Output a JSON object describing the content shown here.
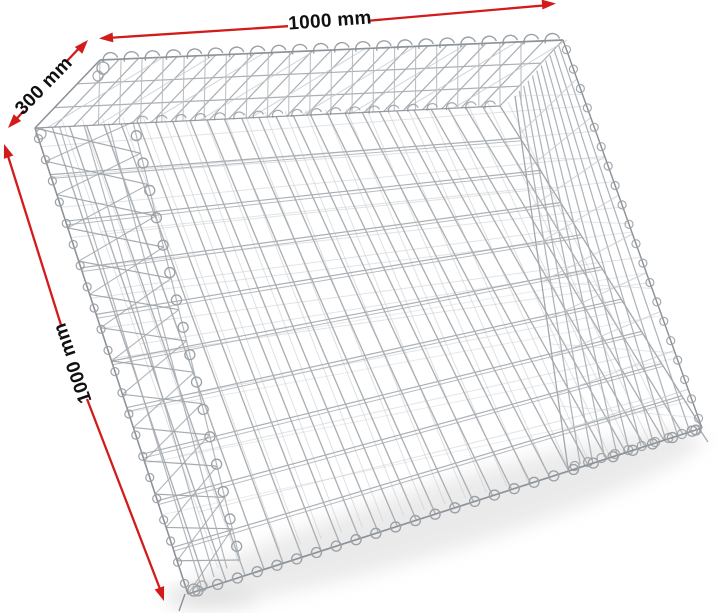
{
  "scene": {
    "type": "product-photo",
    "subject": "galvanized gabion wire mesh basket shown in perspective",
    "background": "#ffffff"
  },
  "labels": {
    "width_top": "1000 mm",
    "depth": "300 mm",
    "height": "1000 mm"
  },
  "colors": {
    "dimension_line": "#d21c1c",
    "label_text": "#101010",
    "wire": "#abb0b5",
    "wire_light": "#c9cdd1",
    "wire_dark": "#8d9298",
    "coil": "#9aa0a5",
    "shadow": "#e4e4e4"
  }
}
